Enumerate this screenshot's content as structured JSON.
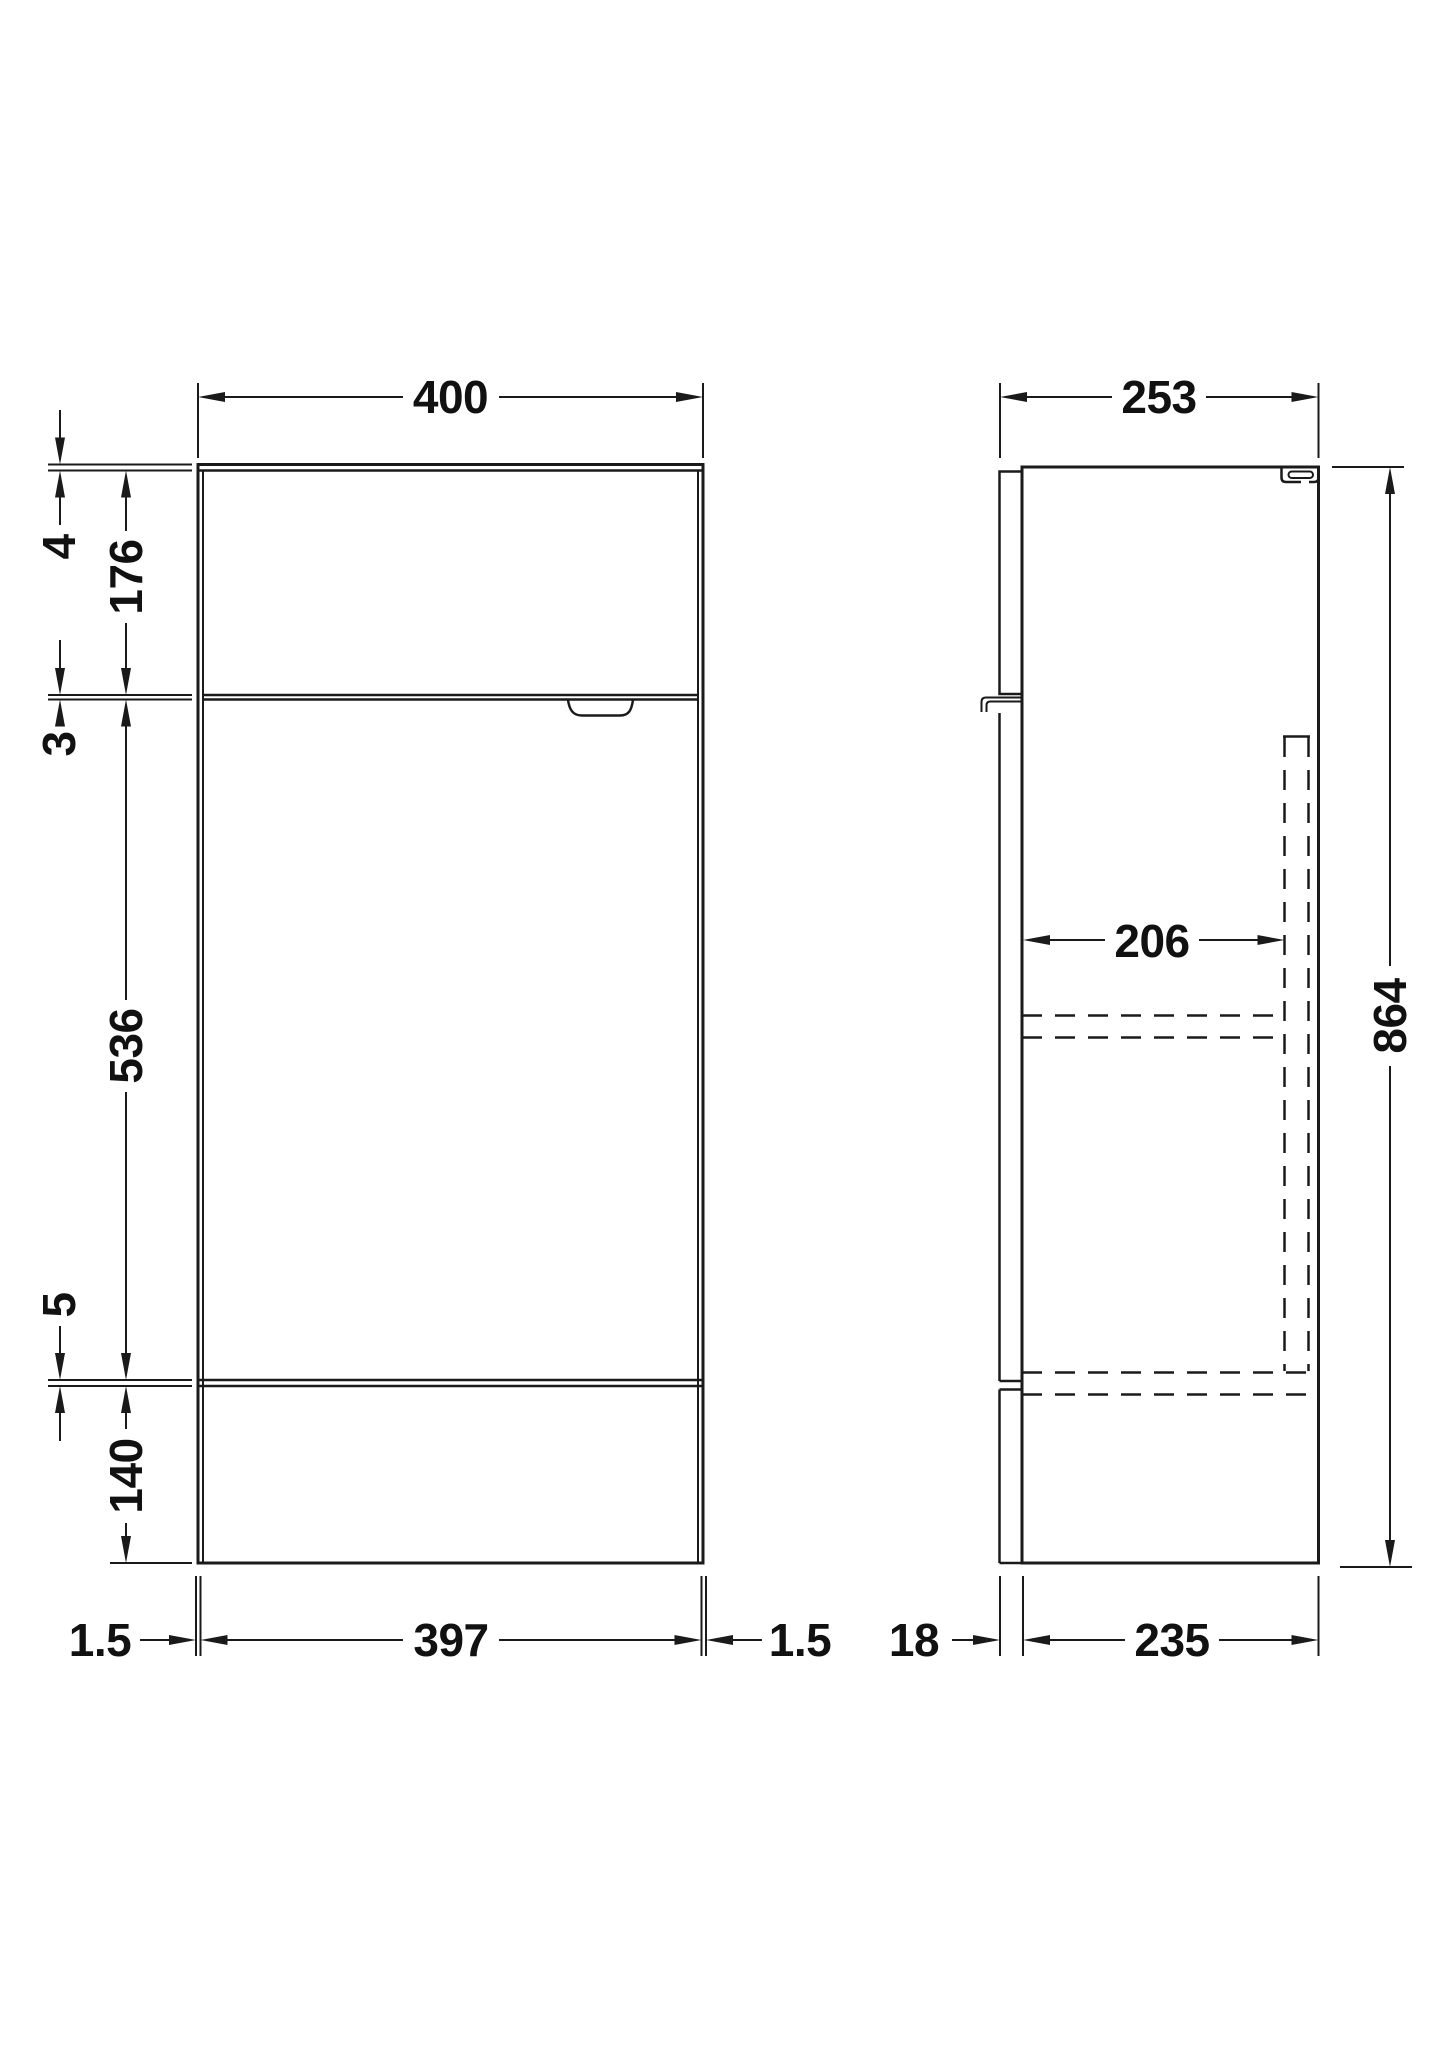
{
  "drawing": {
    "background": "#ffffff",
    "line_color": "#1a1a1a",
    "views": {
      "front": "front-elevation",
      "side": "side-section"
    },
    "dims": {
      "overall_width": "400",
      "worktop_thickness": "4",
      "drawer_front_height": "176",
      "gap_drawer_door": "3",
      "door_height": "536",
      "gap_door_plinth": "5",
      "plinth_height": "140",
      "edge_gap_left": "1.5",
      "door_width": "397",
      "edge_gap_right": "1.5",
      "overall_depth": "253",
      "internal_depth": "206",
      "overall_height": "864",
      "front_panel_thickness": "18",
      "carcass_depth": "235"
    }
  }
}
